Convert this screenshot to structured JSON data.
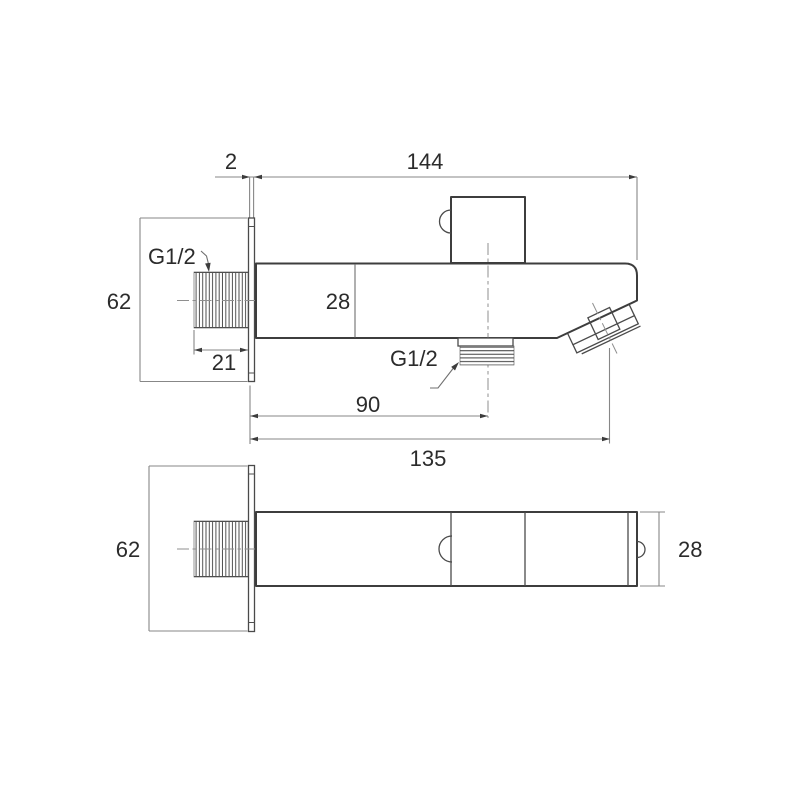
{
  "drawing": {
    "side_view": {
      "plate_thickness": "2",
      "total_length": "144",
      "inlet_thread": "G1/2",
      "plate_height": "62",
      "body_height": "28",
      "inlet_thread_length": "21",
      "outlet_thread": "G1/2",
      "outlet_center_distance": "90",
      "overall_reach": "135"
    },
    "plan_view": {
      "plate_height": "62",
      "body_width": "28"
    },
    "colors": {
      "background": "#ffffff",
      "part_outline": "#3d3d3d",
      "feature_line": "#4a4a4a",
      "dimension_line": "#878787",
      "text": "#2b2b2b"
    }
  }
}
